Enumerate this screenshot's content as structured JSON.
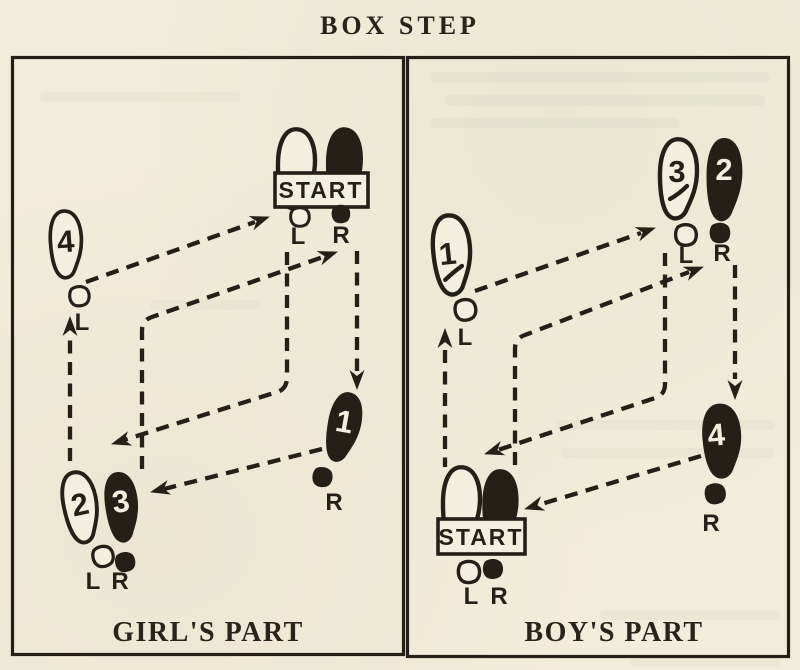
{
  "title": "BOX STEP",
  "colors": {
    "paper": "#f2edda",
    "ink": "#241f17"
  },
  "girl": {
    "caption": "GIRL'S PART",
    "start": {
      "label": "START",
      "left": "L",
      "right": "R"
    },
    "feet": {
      "f1": {
        "number": "1",
        "label": "R"
      },
      "f2": {
        "number": "2"
      },
      "f3": {
        "number": "3"
      },
      "f4": {
        "number": "4",
        "label": "L"
      },
      "pair": {
        "left": "L",
        "right": "R"
      }
    }
  },
  "boy": {
    "caption": "BOY'S PART",
    "start": {
      "label": "START",
      "left": "L",
      "right": "R"
    },
    "feet": {
      "f1": {
        "number": "1",
        "label": "L"
      },
      "f2": {
        "number": "2",
        "label": "R"
      },
      "f3": {
        "number": "3",
        "label": "L"
      },
      "f4": {
        "number": "4",
        "label": "R"
      }
    }
  }
}
